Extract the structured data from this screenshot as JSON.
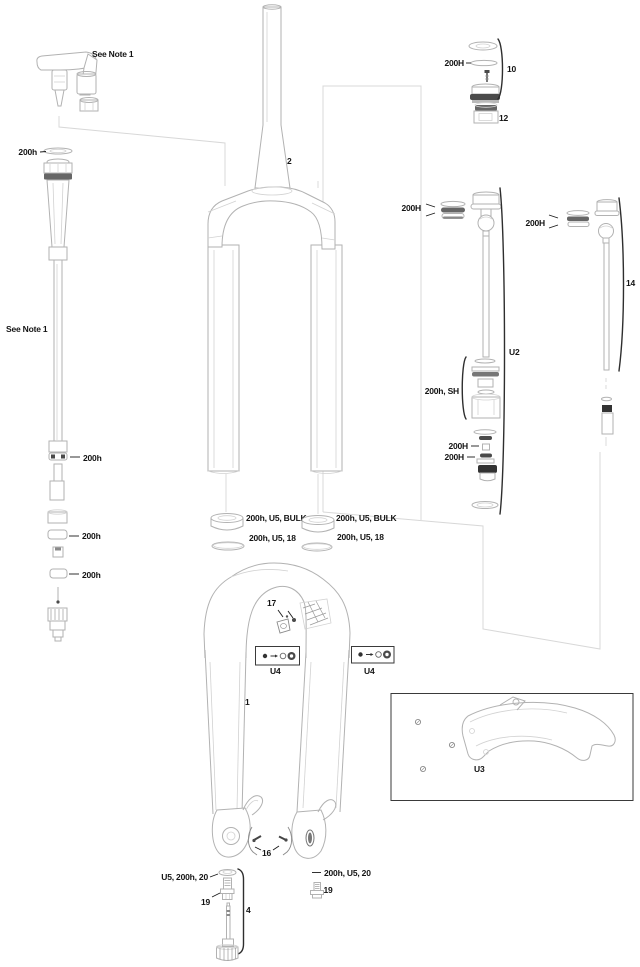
{
  "diagram": {
    "background": "#ffffff",
    "line_color": "#b2b2b2",
    "accent_dark": "#3a3a3a",
    "label_color": "#141414",
    "callouts": {
      "note_top": "See Note 1",
      "ring_top_left": "200h",
      "note_left": "See Note 1",
      "steerer": "2",
      "topcap_seal": "200H",
      "topcap_group": "10",
      "topcap_knob": "12",
      "damper_seal": "200H",
      "damper_group": "U2",
      "piston_kit": "200h, SH",
      "damper_small_a": "200H",
      "damper_small_b": "200H",
      "spring_seal": "200H",
      "spring_group": "14",
      "shaft_ring_a": "200h",
      "shaft_ring_b": "200h",
      "shaft_ring_c": "200h",
      "dust_seal_left": "200h, U5, BULK",
      "foam_ring_left": "200h, U5, 18",
      "dust_seal_right": "200h, U5, BULK",
      "foam_ring_right": "200h, U5, 18",
      "arch_screws": "17",
      "bolt_kit_left": "U4",
      "bolt_kit_right": "U4",
      "lowers": "1",
      "fender_kit": "U3",
      "dropout_screws": "16",
      "washer_left": "U5, 200h, 20",
      "bolt_left": "19",
      "rebound_group": "4",
      "washer_right": "200h, U5, 20",
      "bolt_right": "19"
    }
  }
}
